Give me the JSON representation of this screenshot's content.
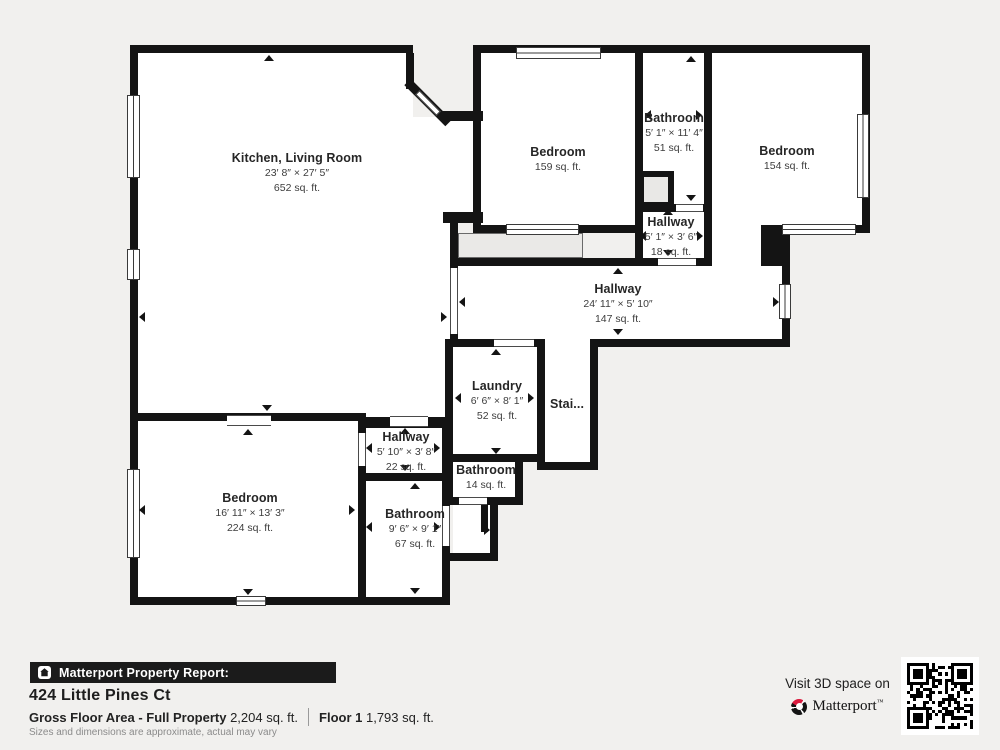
{
  "plan": {
    "wall_color": "#141414",
    "room_fill": "#ffffff",
    "background": "#f1f0ee",
    "rooms": {
      "kitchen_living": {
        "name": "Kitchen, Living Room",
        "dims": "23′ 8″ × 27′ 5″",
        "area": "652 sq. ft."
      },
      "bedroom_top": {
        "name": "Bedroom",
        "area": "159 sq. ft."
      },
      "bathroom_top": {
        "name": "Bathroom",
        "dims": "5′ 1″ × 11′ 4″",
        "area": "51 sq. ft."
      },
      "bedroom_right": {
        "name": "Bedroom",
        "area": "154 sq. ft."
      },
      "hallway_small": {
        "name": "Hallway",
        "dims": "5′ 1″ × 3′ 6″",
        "area": "18 sq. ft."
      },
      "hallway_main": {
        "name": "Hallway",
        "dims": "24′ 11″ × 5′ 10″",
        "area": "147 sq. ft."
      },
      "laundry": {
        "name": "Laundry",
        "dims": "6′ 6″ × 8′ 1″",
        "area": "52 sq. ft."
      },
      "stairs": {
        "name": "Stai..."
      },
      "bathroom_mid": {
        "name": "Bathroom",
        "area": "14 sq. ft."
      },
      "bedroom_bottom": {
        "name": "Bedroom",
        "dims": "16′ 11″ × 13′ 3″",
        "area": "224 sq. ft."
      },
      "hallway_bottom": {
        "name": "Hallway",
        "dims": "5′ 10″ × 3′ 8″",
        "area": "22 sq. ft."
      },
      "bathroom_bottom": {
        "name": "Bathroom",
        "dims": "9′ 6″ × 9′ 1″",
        "area": "67 sq. ft."
      }
    }
  },
  "footer": {
    "report_label": "Matterport Property Report:",
    "address": "424 Little Pines Ct",
    "gfa_label": "Gross Floor Area - Full Property",
    "gfa_value": "2,204 sq. ft.",
    "floor_label": "Floor 1",
    "floor_value": "1,793 sq. ft.",
    "disclaimer": "Sizes and dimensions are approximate, actual may vary",
    "visit_label": "Visit 3D space on",
    "brand": "Matterport"
  },
  "icons": {
    "report_icon": "house-icon",
    "brand_icon": "matterport-ring-icon",
    "qr": "qr-code"
  },
  "colors": {
    "accent_red": "#da1b3e",
    "bar_black": "#1b1b1b",
    "disclaimer_gray": "#8b8b8b"
  }
}
